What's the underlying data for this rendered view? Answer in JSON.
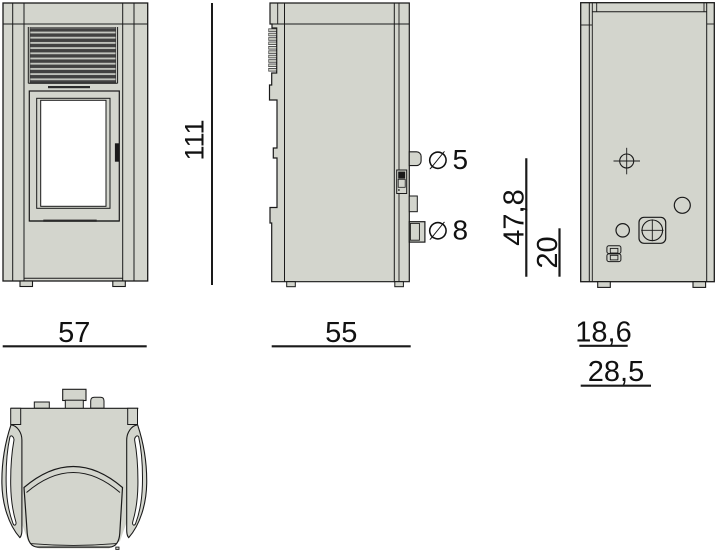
{
  "drawing": {
    "kind": "stove technical dimension drawing",
    "labels": {
      "height": "111",
      "front_width": "57",
      "side_depth": "55",
      "pipe_air_symbol": "∅",
      "pipe_air_value": "5",
      "pipe_smoke_symbol": "∅",
      "pipe_smoke_value": "8",
      "rear_height_upper": "47,8",
      "rear_height_lower": "20",
      "rear_offset_upper": "18,6",
      "rear_offset_lower": "28,5"
    }
  },
  "colors": {
    "background": "#ffffff",
    "body": "#d3d5cd",
    "outline": "#1a1a1a",
    "grille_slat": "#414141",
    "grille_gap": "#c4c6c0",
    "glass": "#ffffff"
  }
}
